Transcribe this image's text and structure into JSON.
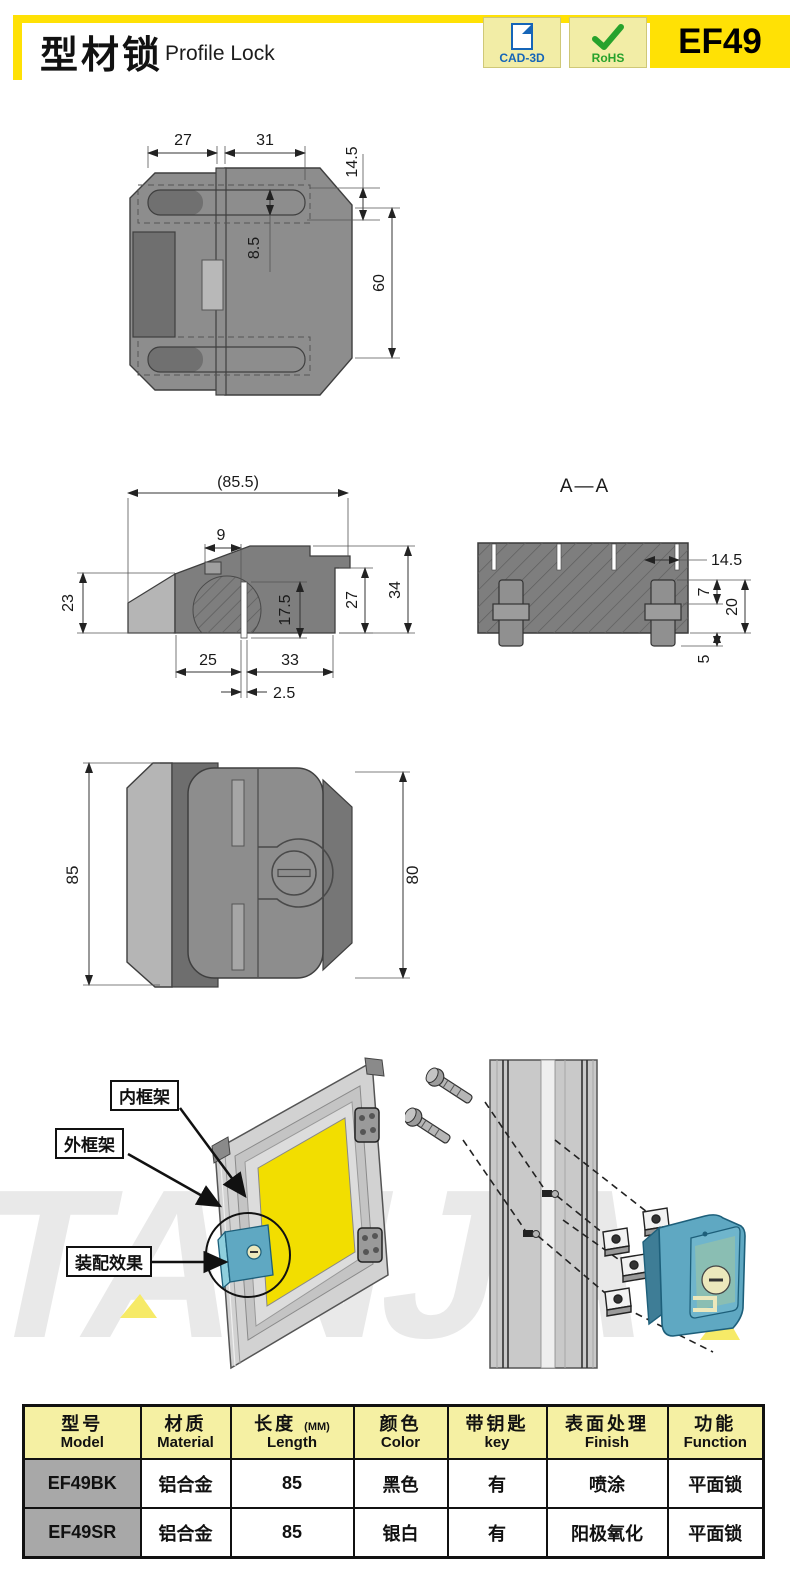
{
  "header": {
    "title_cn": "型材锁",
    "title_en": "Profile Lock",
    "product_code": "EF49",
    "badges": {
      "cad": "CAD-3D",
      "rohs": "RoHS"
    }
  },
  "colors": {
    "accent_yellow": "#ffe105",
    "badge_bg": "#f2eda6",
    "table_header_bg": "#f5f0a3",
    "model_cell_bg": "#a8a8a8",
    "lock_teal": "#5fa8c2",
    "panel_yellow": "#f2de00"
  },
  "drawings": {
    "top_view": {
      "w_left": "27",
      "w_right": "31",
      "offset": "14.5",
      "slot_h": "8.5",
      "height": "60"
    },
    "side_view": {
      "total_w": "(85.5)",
      "step": "9",
      "h_left": "23",
      "depth": "17.5",
      "h_right": "27",
      "total_h": "34",
      "b_left": "25",
      "b_right": "33",
      "gap": "2.5"
    },
    "section_view": {
      "label": "A—A",
      "slot_off": "14.5",
      "cap": "7",
      "pin": "20",
      "tip": "5"
    },
    "front_view": {
      "h_left": "85",
      "h_right": "80"
    }
  },
  "assembly": {
    "labels": {
      "inner_frame": "内框架",
      "outer_frame": "外框架",
      "effect": "装配效果"
    },
    "watermark": "TANJA"
  },
  "table": {
    "headers": [
      {
        "cn": "型号",
        "en": "Model",
        "unit": ""
      },
      {
        "cn": "材质",
        "en": "Material",
        "unit": ""
      },
      {
        "cn": "长度",
        "en": "Length",
        "unit": "(MM)"
      },
      {
        "cn": "颜色",
        "en": "Color",
        "unit": ""
      },
      {
        "cn": "带钥匙",
        "en": "key",
        "unit": ""
      },
      {
        "cn": "表面处理",
        "en": "Finish",
        "unit": ""
      },
      {
        "cn": "功能",
        "en": "Function",
        "unit": ""
      }
    ],
    "rows": [
      [
        "EF49BK",
        "铝合金",
        "85",
        "黑色",
        "有",
        "喷涂",
        "平面锁"
      ],
      [
        "EF49SR",
        "铝合金",
        "85",
        "银白",
        "有",
        "阳极氧化",
        "平面锁"
      ]
    ]
  }
}
